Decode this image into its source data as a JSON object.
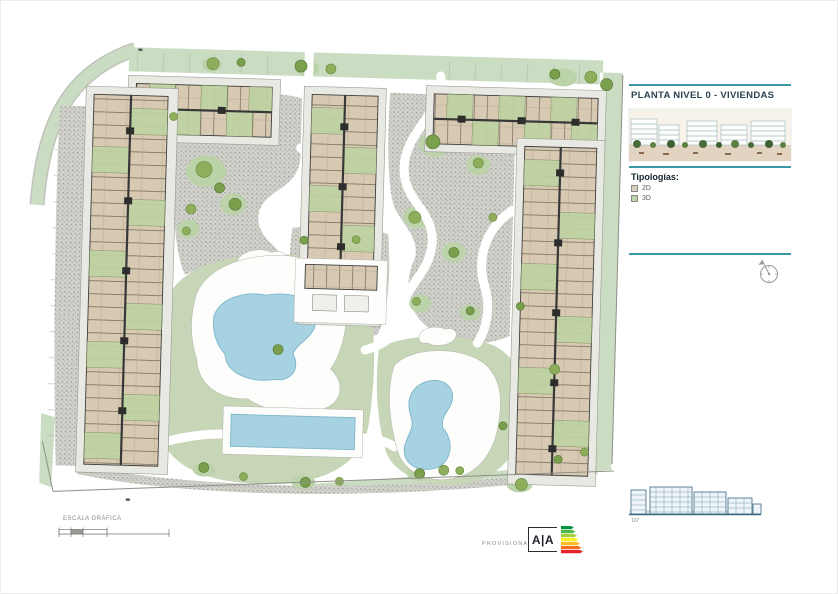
{
  "slide": {
    "accent_color": "#3a99a7",
    "plan_title": "PLANTA NIVEL 0 - VIVIENDAS",
    "typologies": {
      "heading": "Tipologías:",
      "items": [
        {
          "label": "2D",
          "color": "#d9cfbf"
        },
        {
          "label": "3D",
          "color": "#bdd3a9"
        }
      ]
    },
    "scale": {
      "label": "ESCALA GRÁFICA"
    },
    "status": {
      "label": "PROVISIONAL"
    },
    "logo": {
      "text": "A|A"
    },
    "elevation": {
      "label": "107"
    },
    "plan_colors": {
      "lawn": "#c6d6b6",
      "road": "#cadcc2",
      "gravel": "#b4b4ae",
      "pool": "#a6d2e2",
      "unit_2d": "#d8cab2",
      "unit_3d": "#bed3a2"
    }
  }
}
